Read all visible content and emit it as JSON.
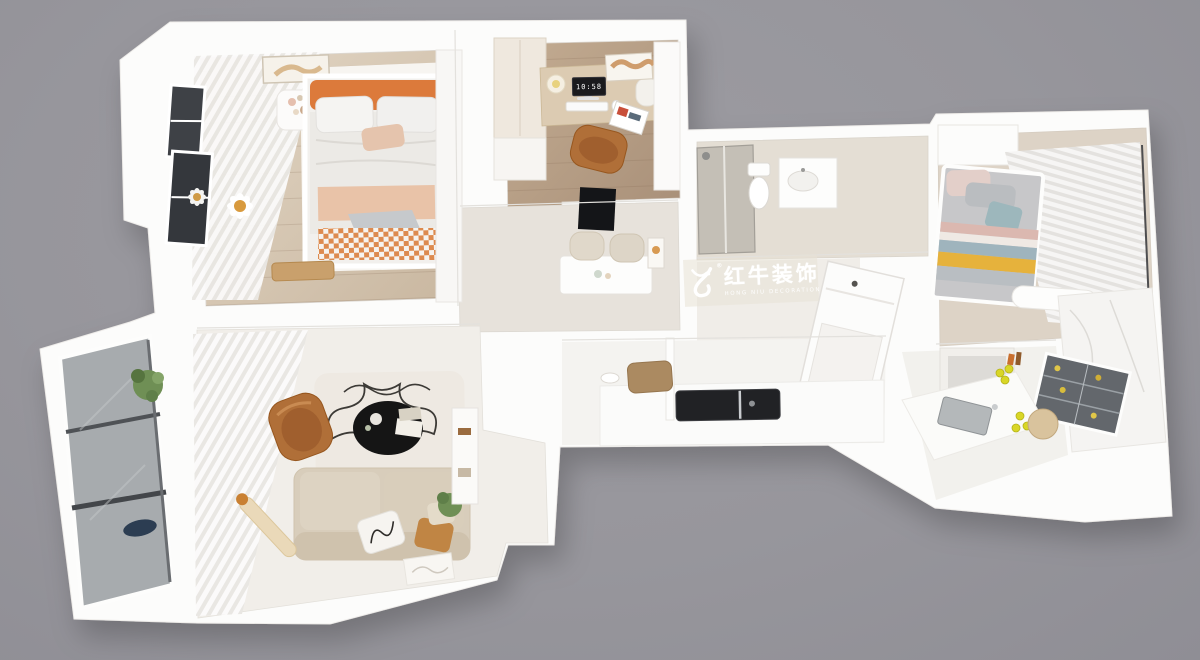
{
  "scene": {
    "type": "3d-apartment-floor-plan-render",
    "view": "top-down-axonometric"
  },
  "watermark": {
    "brand": "红牛装饰",
    "subtitle": "HONG NIU DECORATION",
    "registered_mark": "®",
    "logo": "bull-swoosh-icon",
    "text_color": "#ffffff"
  },
  "study": {
    "monitor_time": "10:58"
  },
  "palette": {
    "bg": "#97969c",
    "bg_light": "#9d9ca2",
    "bg_dark": "#8f8e95",
    "wall_white": "#fcfcfb",
    "wood_light": "#d5c6b4",
    "wood_study": "#b39b82",
    "accent_orange": "#dc7a3b",
    "gingham_orange": "#dd8a4e",
    "sofa_beige": "#d8cdbb",
    "chair_caramel": "#b06f38",
    "throw_peach": "#e9c3a8",
    "stripe_yellow": "#e6b23c",
    "pillow_teal": "#9db7bc",
    "plant_green": "#6f8f55",
    "table_black": "#151515",
    "glass_gray": "#a7abae",
    "window_dark": "#3e4146",
    "screen_dark": "#1a1a1d",
    "lemon_yellow": "#d9d626"
  },
  "rooms": [
    {
      "name": "master-bedroom",
      "objects": [
        "double-bed",
        "orange-headboard",
        "pillows",
        "peach-throw",
        "gingham-runner",
        "nightstand",
        "daisy-wall-decor",
        "sheer-curtains",
        "dark-windows",
        "wall-art",
        "wood-bench",
        "wardrobe"
      ]
    },
    {
      "name": "study",
      "objects": [
        "desk",
        "monitor-clock",
        "keyboard",
        "mouse",
        "desk-lamp",
        "office-chair",
        "wardrobe-cabinet",
        "map-art",
        "magazine",
        "towel-roll"
      ]
    },
    {
      "name": "dining-room",
      "objects": [
        "dining-table",
        "upholstered-chairs",
        "wall-tv",
        "wall-art"
      ]
    },
    {
      "name": "bathroom",
      "objects": [
        "shower-enclosure",
        "toilet",
        "vanity-sink"
      ]
    },
    {
      "name": "entry-hall",
      "objects": [
        "entry-door",
        "storage-niche"
      ]
    },
    {
      "name": "second-bedroom",
      "objects": [
        "bed",
        "striped-blanket",
        "teal-pillow",
        "pleated-curtains",
        "wardrobe",
        "white-ottoman"
      ]
    },
    {
      "name": "kitchen",
      "objects": [
        "glass-front-fridge",
        "counter-sink",
        "black-cooktop",
        "lemons",
        "cutting-board",
        "bench",
        "marble-wall"
      ]
    },
    {
      "name": "living-room",
      "objects": [
        "sofa",
        "throw-pillows",
        "squiggle-pillow",
        "floor-lamp",
        "black-coffee-table",
        "lounge-chair",
        "squiggle-rug",
        "bookshelf",
        "sheer-curtains",
        "potted-plant"
      ]
    },
    {
      "name": "balcony",
      "objects": [
        "glazed-windows",
        "potted-plant",
        "navy-basin"
      ]
    }
  ]
}
